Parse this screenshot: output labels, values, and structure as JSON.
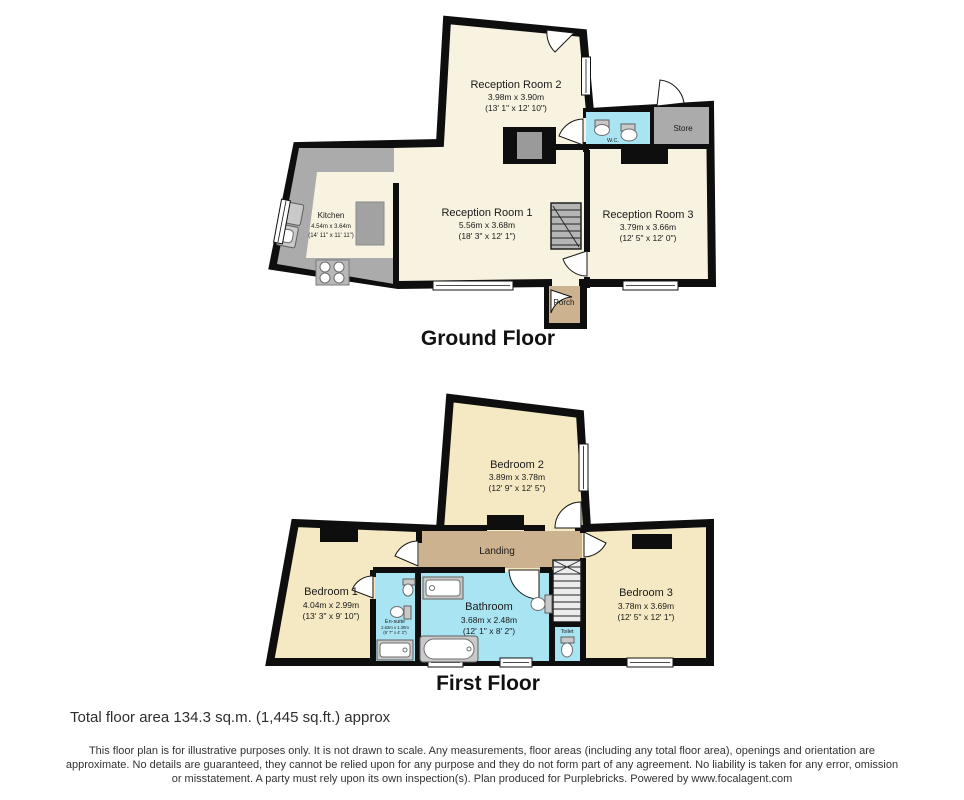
{
  "colors": {
    "wall": "#0e0e0e",
    "ground-room": "#f8f2e0",
    "first-room": "#f5e9c3",
    "wet-room": "#a9e4f2",
    "hallway": "#ccb28e",
    "counter": "#ababab",
    "fixture-gray": "#c9c9c9",
    "stairs": "#b5b5b5",
    "text": "#1a1a1a"
  },
  "ground_floor": {
    "title": "Ground Floor",
    "rooms": {
      "reception2": {
        "name": "Reception Room 2",
        "metric": "3.98m x 3.90m",
        "imperial": "(13' 1\" x 12' 10\")"
      },
      "reception1": {
        "name": "Reception Room 1",
        "metric": "5.56m x 3.68m",
        "imperial": "(18' 3\" x 12' 1\")"
      },
      "reception3": {
        "name": "Reception Room 3",
        "metric": "3.79m x 3.66m",
        "imperial": "(12' 5\" x 12' 0\")"
      },
      "kitchen": {
        "name": "Kitchen",
        "metric": "4.54m x 3.64m",
        "imperial": "(14' 11\" x 11' 11\")"
      },
      "wc": {
        "name": "W.C."
      },
      "store": {
        "name": "Store"
      },
      "porch": {
        "name": "Porch"
      }
    }
  },
  "first_floor": {
    "title": "First Floor",
    "rooms": {
      "bedroom1": {
        "name": "Bedroom 1",
        "metric": "4.04m x 2.99m",
        "imperial": "(13' 3\" x 9' 10\")"
      },
      "bedroom2": {
        "name": "Bedroom 2",
        "metric": "3.89m x 3.78m",
        "imperial": "(12' 9\" x 12' 5\")"
      },
      "bedroom3": {
        "name": "Bedroom 3",
        "metric": "3.78m x 3.69m",
        "imperial": "(12' 5\" x 12' 1\")"
      },
      "bathroom": {
        "name": "Bathroom",
        "metric": "3.68m x 2.48m",
        "imperial": "(12' 1\" x 8' 2\")"
      },
      "landing": {
        "name": "Landing"
      },
      "ensuite": {
        "name": "En-suite",
        "metric": "2.62m x 1.30m",
        "imperial": "(8' 7\" x 4' 3\")"
      },
      "toilet": {
        "name": "Toilet"
      }
    }
  },
  "footer": {
    "total_area": "Total floor area 134.3 sq.m. (1,445 sq.ft.) approx",
    "disclaimer_line1": "This floor plan is for illustrative purposes only. It is not drawn to scale. Any measurements, floor areas (including any total floor area), openings and orientation are",
    "disclaimer_line2": "approximate. No details are guaranteed, they cannot be relied upon for any purpose and they do not form part of any agreement. No liability is taken for any error, omission",
    "disclaimer_line3": "or misstatement. A party must rely upon its own inspection(s). Plan produced for Purplebricks. Powered by www.focalagent.com"
  }
}
